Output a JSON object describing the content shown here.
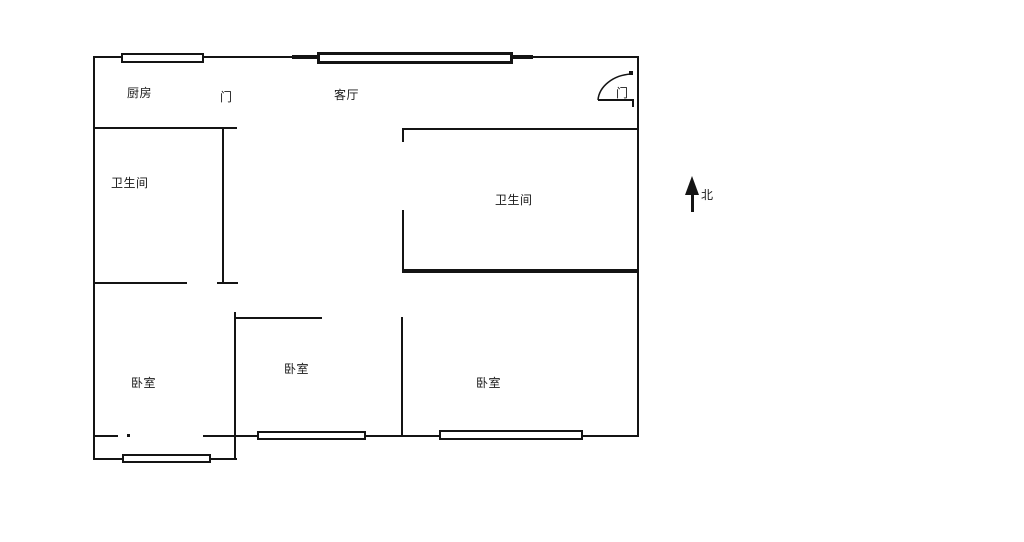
{
  "page": {
    "background": "#ffffff",
    "ink": "#141414",
    "type_note": "apartment floor plan line drawing"
  },
  "floorplan": {
    "labels": [
      {
        "name": "kitchen-label",
        "text": "厨房",
        "x": 127,
        "y": 87,
        "fs": 12
      },
      {
        "name": "kitchen-door-label",
        "text": "门",
        "x": 220,
        "y": 91,
        "fs": 12
      },
      {
        "name": "living-room-label",
        "text": "客厅",
        "x": 334,
        "y": 89,
        "fs": 12
      },
      {
        "name": "bathroom-left-label",
        "text": "卫生间",
        "x": 111,
        "y": 177,
        "fs": 12
      },
      {
        "name": "bathroom-center-label",
        "text": "卫生间",
        "x": 495,
        "y": 194,
        "fs": 12
      },
      {
        "name": "bedroom-left-label",
        "text": "卧室",
        "x": 131,
        "y": 377,
        "fs": 12
      },
      {
        "name": "bedroom-middle-label",
        "text": "卧室",
        "x": 284,
        "y": 363,
        "fs": 12
      },
      {
        "name": "bedroom-right-label",
        "text": "卧室",
        "x": 476,
        "y": 377,
        "fs": 12
      },
      {
        "name": "entry-door-label",
        "text": "门",
        "x": 616,
        "y": 87,
        "fs": 12
      },
      {
        "name": "north-label",
        "text": "北",
        "x": 701,
        "y": 189,
        "fs": 12
      }
    ],
    "walls": [
      {
        "name": "top-wall",
        "x": 94,
        "y": 56,
        "w": 545,
        "h": 2
      },
      {
        "name": "left-wall",
        "x": 93,
        "y": 56,
        "w": 2,
        "h": 404
      },
      {
        "name": "right-wall",
        "x": 637,
        "y": 56,
        "w": 2,
        "h": 381
      },
      {
        "name": "kitchen-bottom-wall",
        "x": 94,
        "y": 127,
        "w": 143,
        "h": 2
      },
      {
        "name": "left-bathroom-right-wall",
        "x": 222,
        "y": 127,
        "w": 2,
        "h": 157
      },
      {
        "name": "left-bathroom-bottom-cap",
        "x": 217,
        "y": 282,
        "w": 21,
        "h": 2
      },
      {
        "name": "left-bathroom-bottom-wall",
        "x": 94,
        "y": 282,
        "w": 93,
        "h": 2
      },
      {
        "name": "center-bathroom-top-wall",
        "x": 402,
        "y": 128,
        "w": 237,
        "h": 2
      },
      {
        "name": "center-bathroom-door-jamb",
        "x": 402,
        "y": 128,
        "w": 2,
        "h": 14
      },
      {
        "name": "center-bathroom-left-wall",
        "x": 402,
        "y": 210,
        "w": 2,
        "h": 62
      },
      {
        "name": "center-bathroom-bottom-wall",
        "x": 402,
        "y": 269,
        "w": 237,
        "h": 4
      },
      {
        "name": "middle-bedroom-top-wall",
        "x": 234,
        "y": 317,
        "w": 88,
        "h": 2
      },
      {
        "name": "middle-bedroom-left-wall",
        "x": 234,
        "y": 312,
        "w": 2,
        "h": 148
      },
      {
        "name": "bedroom-divider-wall",
        "x": 401,
        "y": 317,
        "w": 2,
        "h": 120
      },
      {
        "name": "bottom-wall-left-stub",
        "x": 94,
        "y": 435,
        "w": 24,
        "h": 2
      },
      {
        "name": "bottom-wall-door-mark",
        "x": 127,
        "y": 434,
        "w": 3,
        "h": 3
      },
      {
        "name": "bottom-wall-main",
        "x": 203,
        "y": 435,
        "w": 436,
        "h": 2
      },
      {
        "name": "balcony-bottom-wall",
        "x": 94,
        "y": 458,
        "w": 143,
        "h": 2
      },
      {
        "name": "window-living-stub-left",
        "x": 292,
        "y": 55,
        "w": 26,
        "h": 4
      },
      {
        "name": "window-living-stub-right",
        "x": 512,
        "y": 55,
        "w": 21,
        "h": 4
      },
      {
        "name": "entry-door-leaf",
        "x": 598,
        "y": 99,
        "w": 36,
        "h": 2
      },
      {
        "name": "entry-door-leaf-end",
        "x": 632,
        "y": 99,
        "w": 2,
        "h": 8
      },
      {
        "name": "entry-door-hinge-dot",
        "x": 629,
        "y": 71,
        "w": 4,
        "h": 4
      }
    ],
    "windows": [
      {
        "name": "window-kitchen",
        "x": 121,
        "y": 53,
        "w": 83,
        "h": 10,
        "style": "thin"
      },
      {
        "name": "window-living-room",
        "x": 317,
        "y": 52,
        "w": 196,
        "h": 12,
        "style": "thick"
      },
      {
        "name": "window-middle-bedroom",
        "x": 257,
        "y": 431,
        "w": 109,
        "h": 9,
        "style": "thin"
      },
      {
        "name": "window-right-bedroom",
        "x": 439,
        "y": 430,
        "w": 144,
        "h": 10,
        "style": "thin"
      },
      {
        "name": "window-balcony",
        "x": 122,
        "y": 454,
        "w": 89,
        "h": 9,
        "style": "thin"
      }
    ],
    "entry_door_arc": {
      "name": "entry-door-arc",
      "x": 555,
      "y": 48,
      "w": 90,
      "h": 70,
      "path": "M 43 52 A 36 28 0 0 1 76 26"
    },
    "north_arrow": {
      "name": "north-arrow",
      "triangle": {
        "x": 685,
        "y": 176
      },
      "shaft": {
        "x": 691,
        "y": 192,
        "w": 3,
        "h": 20
      }
    }
  }
}
